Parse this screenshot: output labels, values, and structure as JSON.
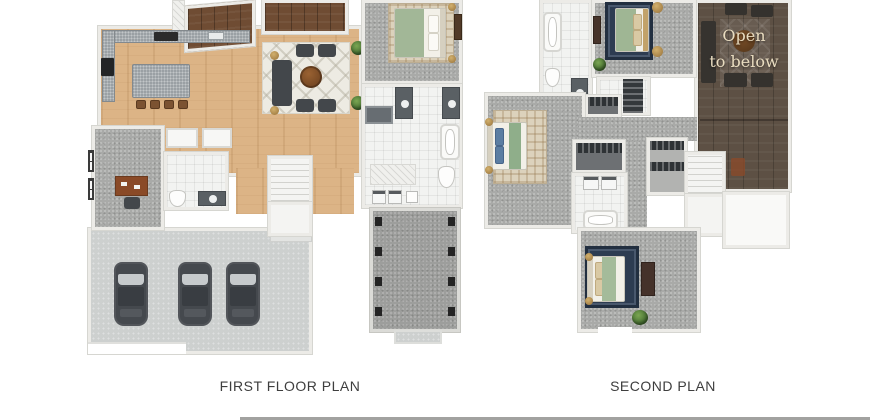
{
  "first_floor": {
    "label": "FIRST FLOOR PLAN"
  },
  "second_floor": {
    "label": "SECOND PLAN",
    "annotation": {
      "line1": "Open",
      "line2": "to below"
    }
  },
  "colors": {
    "background": "#ffffff",
    "wood_floor": "#dcb486",
    "deck_wood": "#6f4c33",
    "open_below_wood": "#5d5044",
    "carpet_gray": "#a9aaa8",
    "tile_white": "#f2f3f1",
    "concrete_gray": "#cdd0cf",
    "wall_white": "#ecebe7",
    "furniture_dark": "#43474b",
    "bedding_green": "#a2b797",
    "rug_navy": "#2d3c51",
    "accent_gold": "#b48c4c",
    "label_text": "#3e3e3e",
    "annotation_text": "#e9dcc0"
  }
}
